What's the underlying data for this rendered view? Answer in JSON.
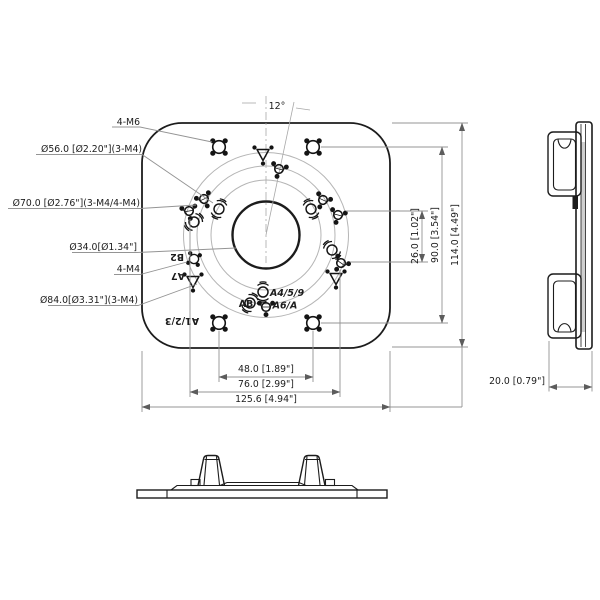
{
  "title": "Mounting plate dimensional drawing",
  "front_view": {
    "angle_label": "12°",
    "callouts": [
      {
        "label": "4-M6"
      },
      {
        "label": "Ø56.0 [Ø2.20\"](3-M4)"
      },
      {
        "label": "Ø70.0 [Ø2.76\"](3-M4/4-M4)"
      },
      {
        "label": "Ø34.0[Ø1.34\"]"
      },
      {
        "label": "4-M4"
      },
      {
        "label": "Ø84.0[Ø3.31\"](3-M4)"
      }
    ],
    "engraved": {
      "b2": "B2",
      "a7": "A7",
      "a123": "A1/2/3",
      "ab": "AB",
      "a459": "A4/5/9",
      "a6a": "A6/A"
    },
    "dims": {
      "right": [
        {
          "label": "26.0 [1.02\"]"
        },
        {
          "label": "90.0 [3.54\"]"
        },
        {
          "label": "114.0 [4.49\"]"
        }
      ],
      "bottom": [
        {
          "label": "48.0 [1.89\"]"
        },
        {
          "label": "76.0 [2.99\"]"
        },
        {
          "label": "125.6 [4.94\"]"
        }
      ]
    }
  },
  "side_view": {
    "depth_dim": "20.0 [0.79\"]"
  },
  "colors": {
    "line": "#1c1c1c",
    "thin_line": "#949494",
    "circle_line": "#b5b5b5",
    "background": "#ffffff"
  }
}
